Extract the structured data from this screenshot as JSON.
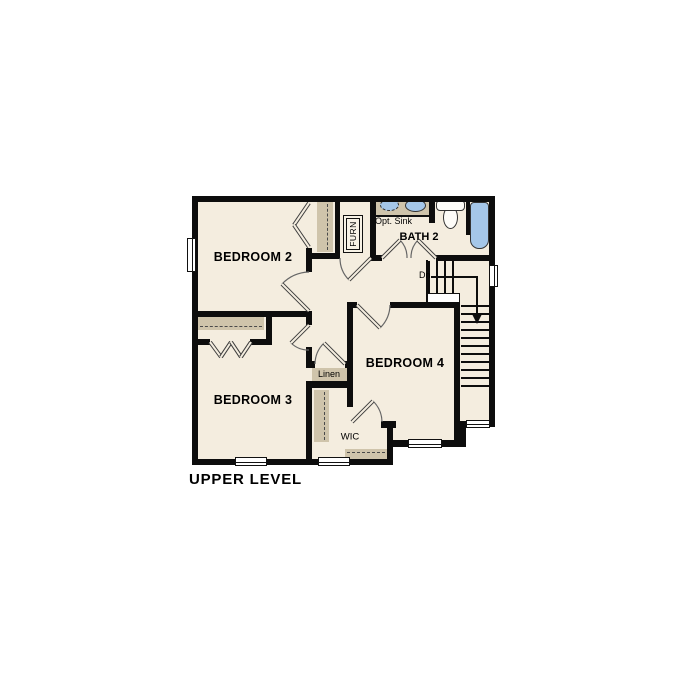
{
  "title": "UPPER LEVEL",
  "rooms": {
    "bedroom2": {
      "label": "BEDROOM 2"
    },
    "bedroom3": {
      "label": "BEDROOM 3"
    },
    "bedroom4": {
      "label": "BEDROOM 4"
    },
    "bath2": {
      "label": "BATH 2"
    }
  },
  "labels": {
    "opt_sink": "Opt. Sink",
    "down": "Dn",
    "linen": "Linen",
    "wic": "WIC",
    "furnace": "FURN"
  },
  "colors": {
    "background": "#ffffff",
    "floor": "#f4eddf",
    "wall": "#0d0d0d",
    "shelf_tan": "#cfc4ab",
    "fixture_blue": "#a5c7e9",
    "text": "#000000"
  }
}
